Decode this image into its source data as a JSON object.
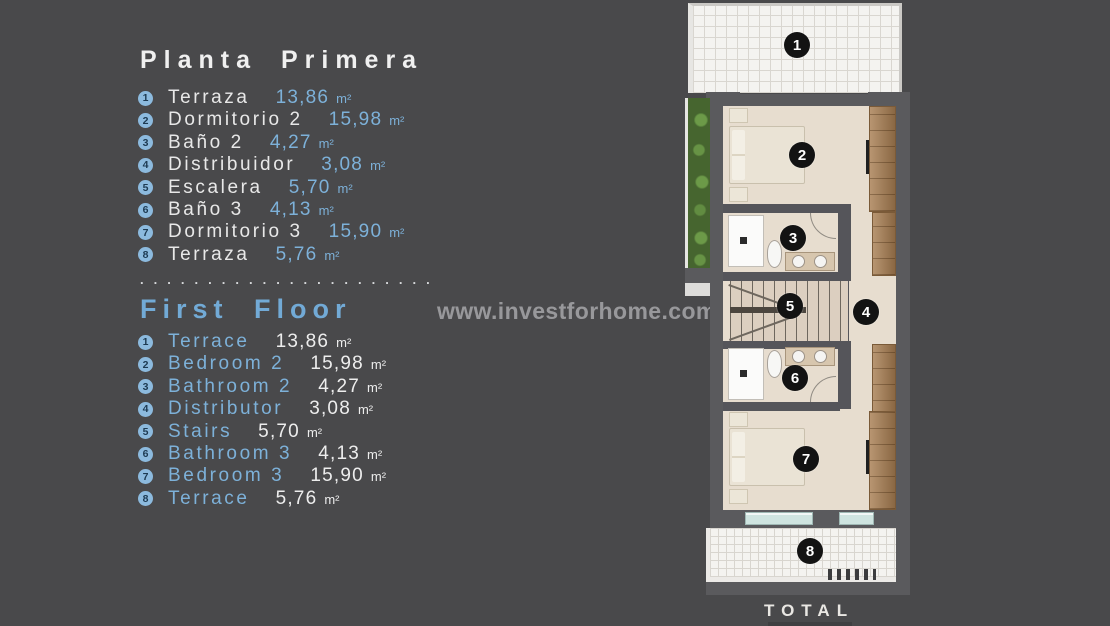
{
  "colors": {
    "background": "#49494b",
    "accent_blue": "#7db1d9",
    "white_text": "#e8e8e8",
    "list_circle": "#8cbade",
    "badge": "#131313",
    "wall": "#5a5a5d",
    "floor_beige": "#e7ddcf",
    "wood": "#a87e52",
    "tile": "#f4f3f0",
    "glass": "#cfe4e0",
    "garden_green": "#46652f",
    "watermark_gray": "#98989b"
  },
  "left_panel": {
    "title_es": "Planta Primera",
    "rooms_es": [
      {
        "num": "1",
        "name": "Terraza",
        "value": "13,86",
        "unit": "m²"
      },
      {
        "num": "2",
        "name": "Dormitorio 2",
        "value": "15,98",
        "unit": "m²"
      },
      {
        "num": "3",
        "name": "Baño 2",
        "value": "4,27",
        "unit": "m²"
      },
      {
        "num": "4",
        "name": "Distribuidor",
        "value": "3,08",
        "unit": "m²"
      },
      {
        "num": "5",
        "name": "Escalera",
        "value": "5,70",
        "unit": "m²"
      },
      {
        "num": "6",
        "name": "Baño 3",
        "value": "4,13",
        "unit": "m²"
      },
      {
        "num": "7",
        "name": "Dormitorio 3",
        "value": "15,90",
        "unit": "m²"
      },
      {
        "num": "8",
        "name": "Terraza",
        "value": "5,76",
        "unit": "m²"
      }
    ],
    "separator": ". . . . . . . . . . . . . . . . . . . . . .",
    "title_en": "First Floor",
    "rooms_en": [
      {
        "num": "1",
        "name": "Terrace",
        "value": "13,86",
        "unit": "m²"
      },
      {
        "num": "2",
        "name": "Bedroom 2",
        "value": "15,98",
        "unit": "m²"
      },
      {
        "num": "3",
        "name": "Bathroom 2",
        "value": "4,27",
        "unit": "m²"
      },
      {
        "num": "4",
        "name": "Distributor",
        "value": "3,08",
        "unit": "m²"
      },
      {
        "num": "5",
        "name": "Stairs",
        "value": "5,70",
        "unit": "m²"
      },
      {
        "num": "6",
        "name": "Bathroom 3",
        "value": "4,13",
        "unit": "m²"
      },
      {
        "num": "7",
        "name": "Bedroom 3",
        "value": "15,90",
        "unit": "m²"
      },
      {
        "num": "8",
        "name": "Terrace",
        "value": "5,76",
        "unit": "m²"
      }
    ]
  },
  "watermark": "www.investforhome.com",
  "floor_plan": {
    "badges": [
      {
        "num": "1",
        "room": "terrace-top",
        "x": 115,
        "y": 45
      },
      {
        "num": "2",
        "room": "bedroom-2",
        "x": 120,
        "y": 155
      },
      {
        "num": "3",
        "room": "bathroom-2",
        "x": 111,
        "y": 238
      },
      {
        "num": "4",
        "room": "distributor",
        "x": 184,
        "y": 312
      },
      {
        "num": "5",
        "room": "stairs",
        "x": 108,
        "y": 306
      },
      {
        "num": "6",
        "room": "bathroom-3",
        "x": 113,
        "y": 378
      },
      {
        "num": "7",
        "room": "bedroom-3",
        "x": 124,
        "y": 459
      },
      {
        "num": "8",
        "room": "terrace-bottom",
        "x": 128,
        "y": 551
      }
    ],
    "total_label": "TOTAL"
  }
}
